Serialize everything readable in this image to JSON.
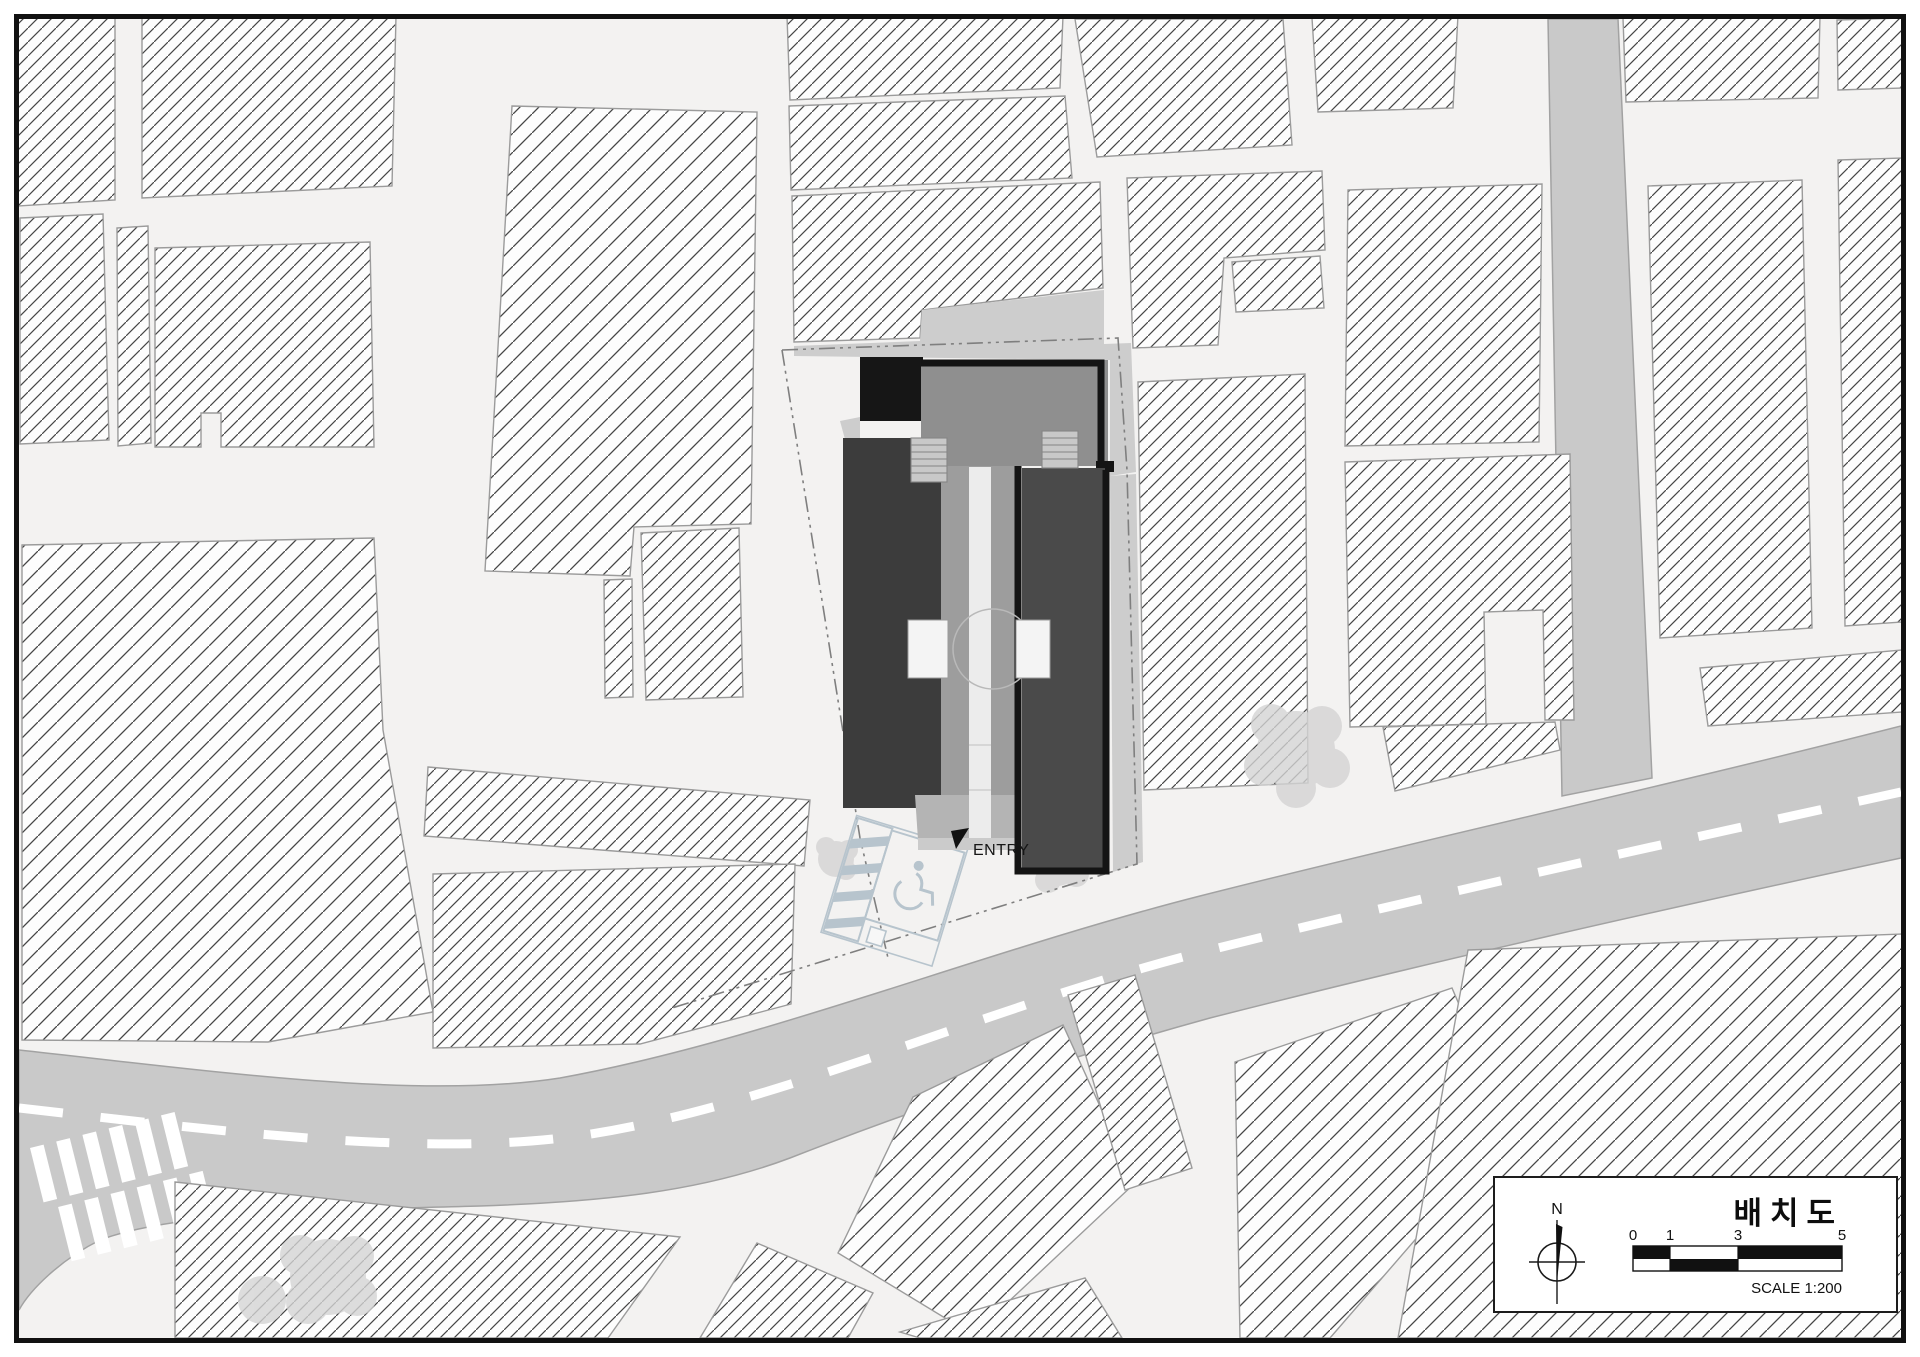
{
  "drawing": {
    "title": "배치도",
    "scale_label": "SCALE 1:200",
    "entry_label": "ENTRY",
    "north_label": "N",
    "scale_ticks": [
      "0",
      "1",
      "3",
      "5"
    ]
  },
  "icons": {
    "north_arrow": "compass-north-needle",
    "entry_marker": "black-flag-triangle",
    "accessible_parking": "wheelchair-symbol"
  },
  "colors": {
    "road": "#c9c9c9",
    "ground": "#cdcdcd",
    "background": "#f3f2f1",
    "wing_dark": "#3c3c3c",
    "wing_mid": "#4a4a4a",
    "roof": "#8f8f8f",
    "corridor": "#9d9d9d",
    "ink": "#161616",
    "parking": "#b7c4cd",
    "tree": "#d4d4d4",
    "hatchline": "#454545"
  }
}
